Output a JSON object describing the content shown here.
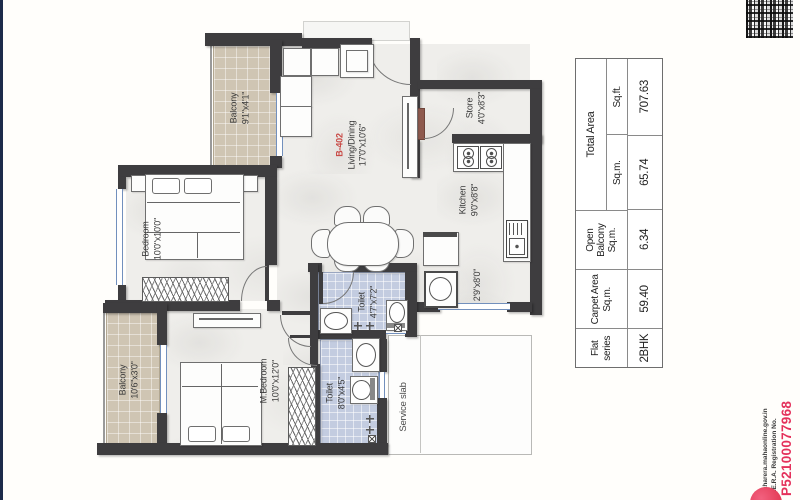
{
  "plan": {
    "rooms": {
      "balcony_top": {
        "name": "Balcony",
        "dims": "9'1\"x4'1\""
      },
      "bedroom": {
        "name": "Bedroom",
        "dims": "10'0\"x10'0\""
      },
      "living": {
        "unit": "B-402",
        "name": "Living/Dining",
        "dims": "17'0\"x10'6\""
      },
      "store": {
        "name": "Store",
        "dims": "4'0\"x8'3\""
      },
      "kitchen": {
        "name": "Kitchen",
        "dims": "9'0\"x8'8\""
      },
      "utility": {
        "dims": "2'9\"x8'0\""
      },
      "toilet_common": {
        "name": "Toilet",
        "dims": "4'7\"x7'2\""
      },
      "toilet_master": {
        "name": "Toilet",
        "dims": "8'0\"x4'5\""
      },
      "balcony_bottom": {
        "name": "Balcony",
        "dims": "10'6\"x3'0\""
      },
      "m_bedroom": {
        "name": "M.Bedroom",
        "dims": "10'0\"x12'0\""
      },
      "service_slab": {
        "name": "Service slab"
      }
    }
  },
  "area_table": {
    "headers": {
      "flat_series": "Flat series",
      "carpet": "Carpet Area",
      "carpet_unit": "Sq.m.",
      "open_balcony": "Open Balcony",
      "open_unit": "Sq.m.",
      "total": "Total Area",
      "total_sqm": "Sq.m.",
      "total_sqft": "Sq.ft."
    },
    "values": {
      "flat_series": "2BHK",
      "carpet_sqm": "59.40",
      "open_sqm": "6.34",
      "total_sqm": "65.74",
      "total_sqft": "707.63"
    }
  },
  "rera": {
    "website": "maharera.mahaonline.gov.in",
    "registration_label": "R.E.R.A. Registration No.",
    "registration_number": "P52100077968"
  },
  "colors": {
    "wall": "#3e3d3f",
    "balcony_floor": "#cfc5b3",
    "toilet_floor": "#c3cce0",
    "unit_red": "#c94b47",
    "rera_red": "#e4315b",
    "edge_navy": "#1c2b4a"
  }
}
